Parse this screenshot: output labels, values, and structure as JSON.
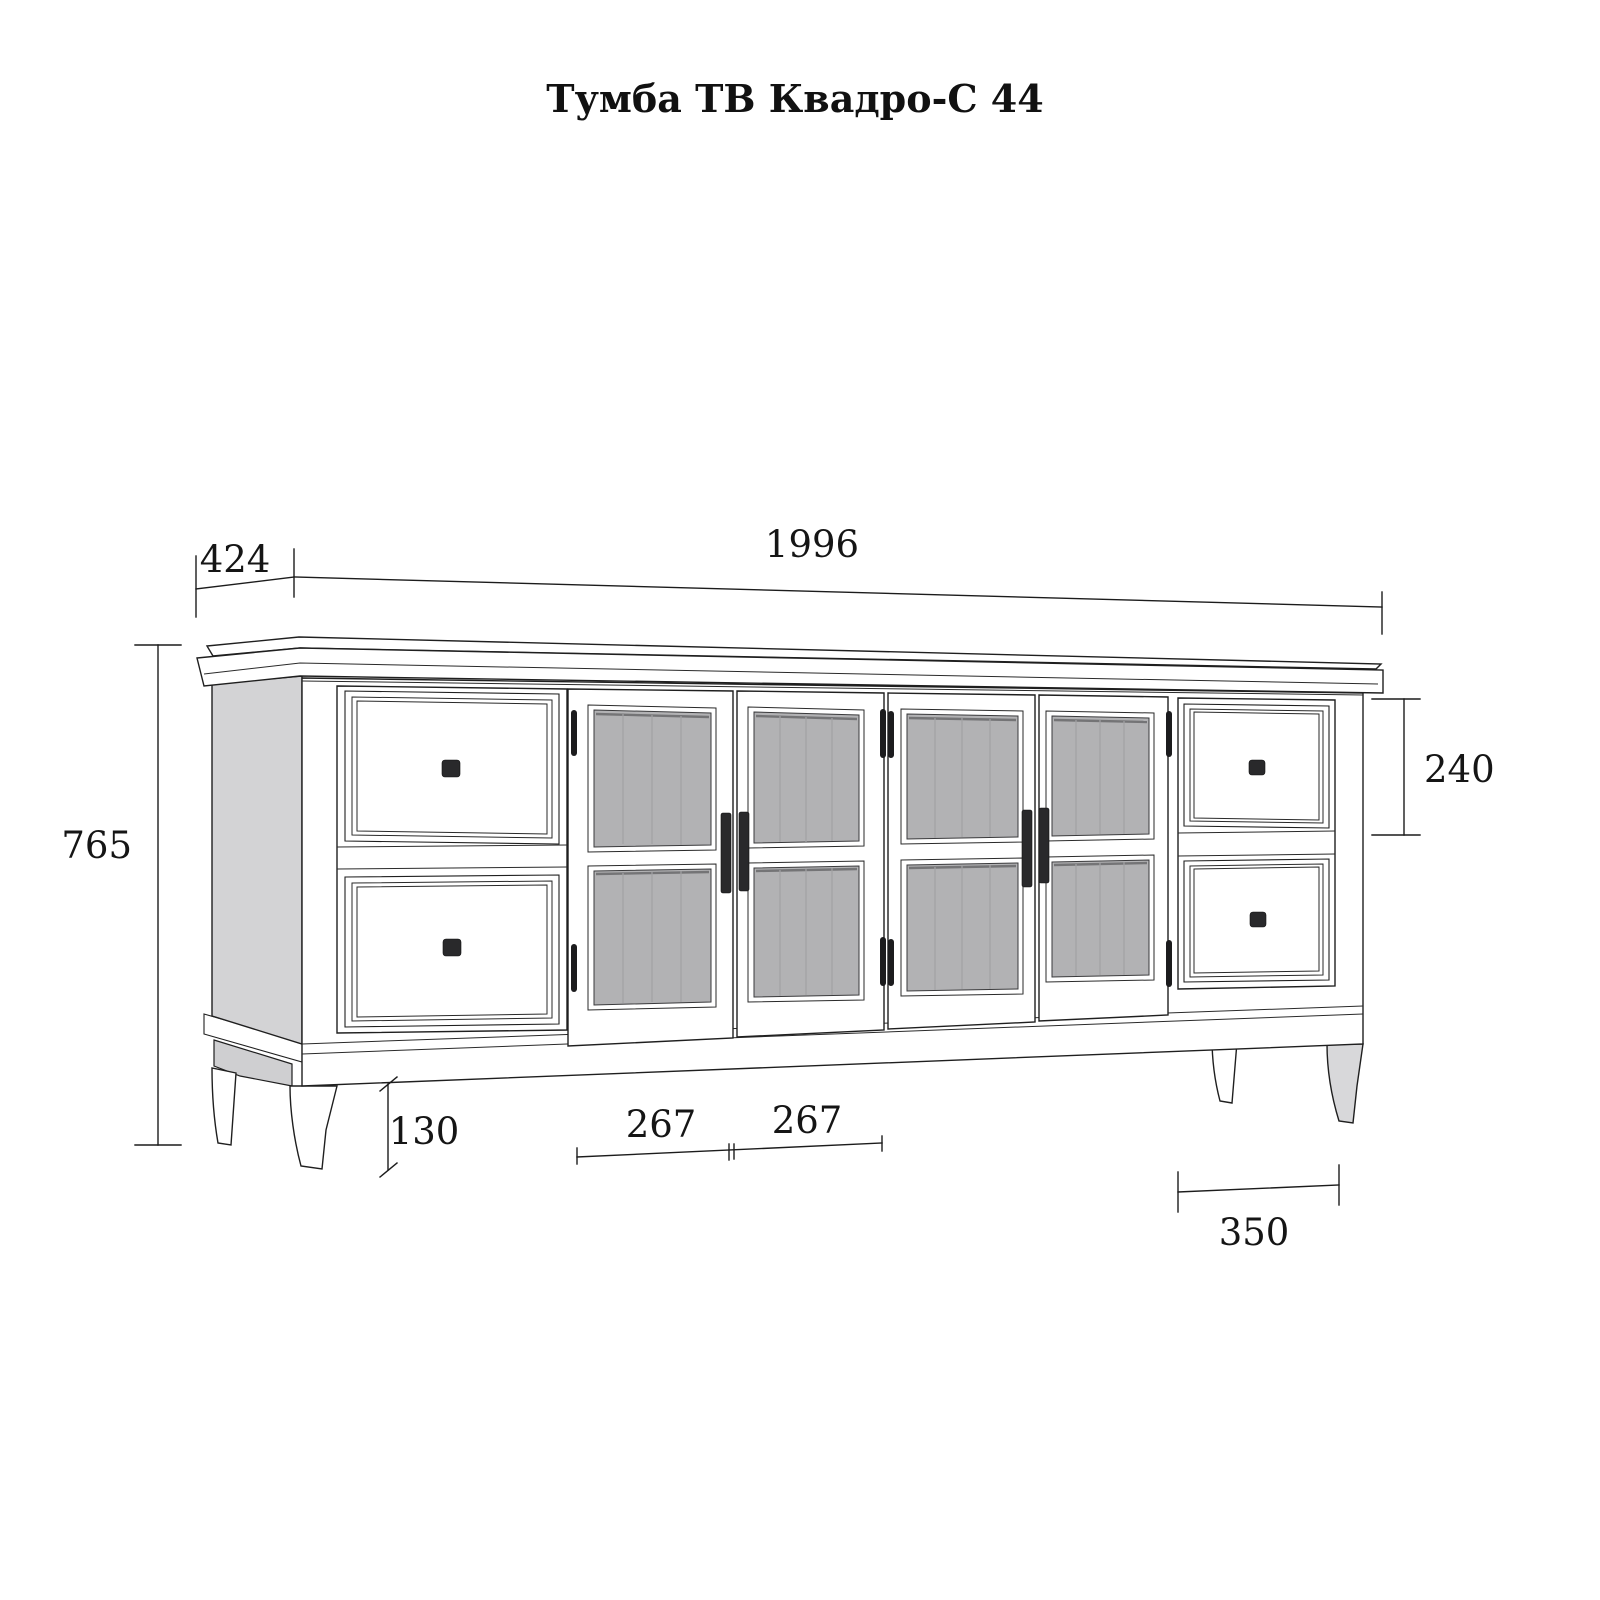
{
  "title": "Тумба ТВ Квадро-С 44",
  "dims": {
    "width": "1996",
    "depth": "424",
    "height": "765",
    "drawer_height": "240",
    "leg_height": "130",
    "door_left": "267",
    "door_right": "267",
    "drawer_width": "350"
  },
  "colors": {
    "background": "#ffffff",
    "line": "#1f1f1f",
    "dimension_line": "#1c1c1c",
    "glass": "#b2b2b4",
    "side_panel": "#d3d3d5",
    "leg_shade": "#d8d8da",
    "handle": "#29292b"
  }
}
